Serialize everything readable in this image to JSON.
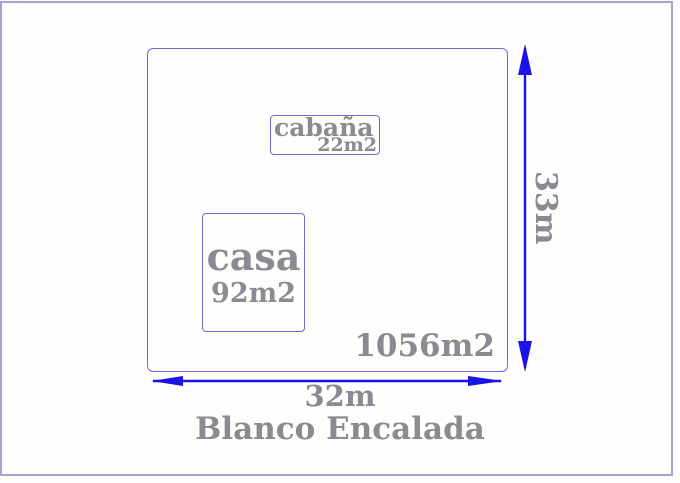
{
  "title": "Blanco Encalada",
  "diagram": {
    "lot": {
      "area": "1056m2",
      "width": "32m",
      "height": "33m"
    },
    "cabana": {
      "name": "cabaña",
      "area": "22m2"
    },
    "casa": {
      "name": "casa",
      "area": "92m2"
    }
  },
  "colors": {
    "dimension_blue": "#1c12e6",
    "outline_purple": "#7569d6",
    "frame_purple": "#a9a2cf",
    "label_gray": "#8a8a92"
  }
}
